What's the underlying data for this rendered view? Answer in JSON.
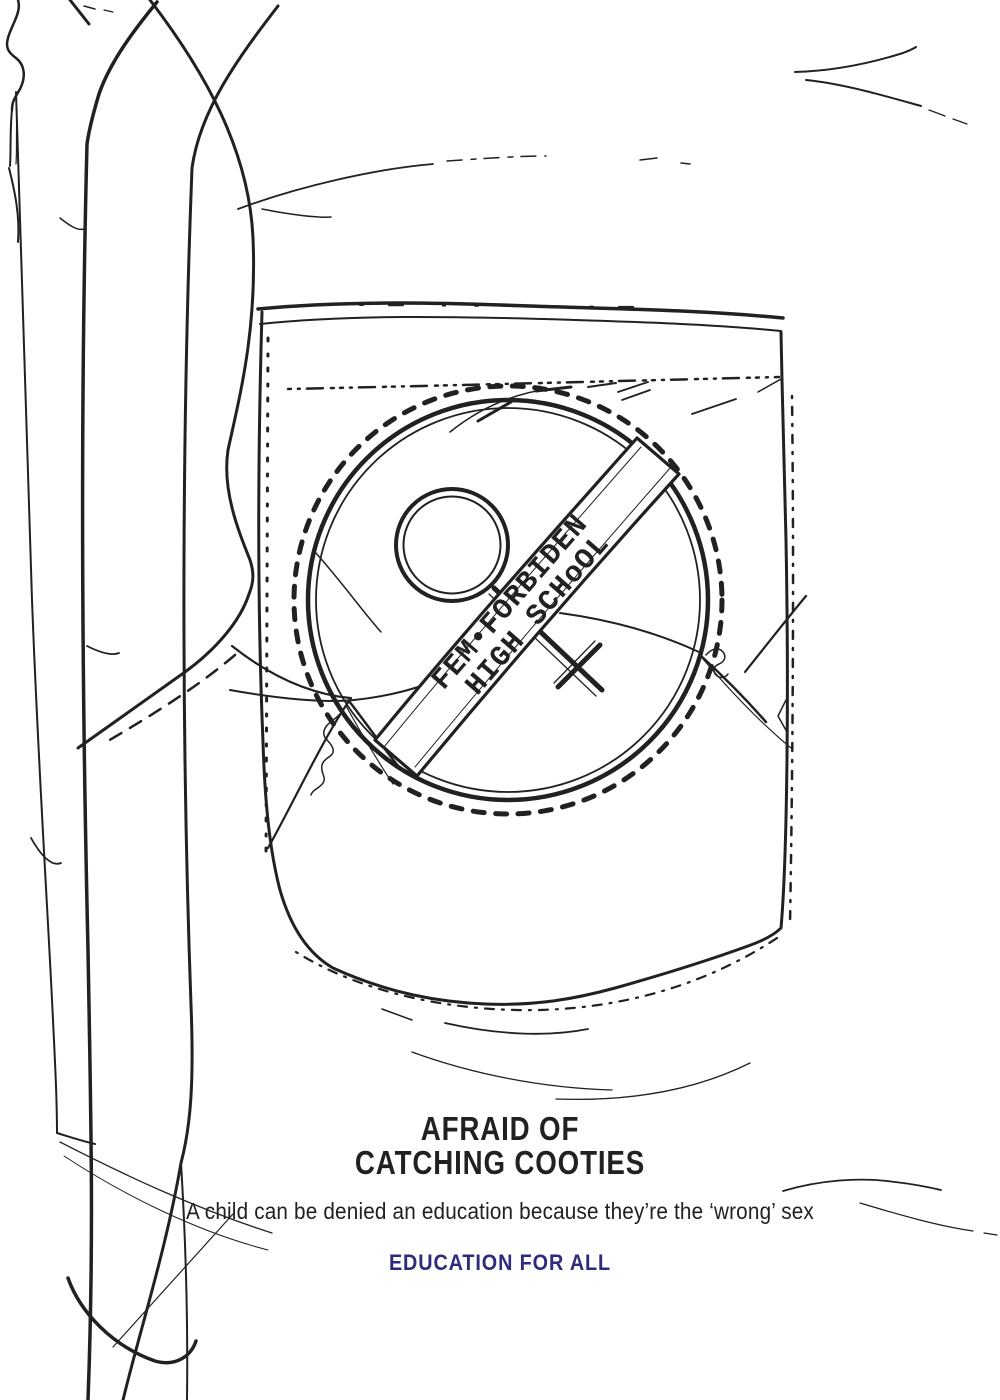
{
  "colors": {
    "ink": "#232021",
    "accent": "#2f2a7b"
  },
  "badge": {
    "symbol_icon": "female-gender-symbol",
    "banner_line1": "FEM•FORBIDEN",
    "banner_line2": "HIGH SCHoOL"
  },
  "headline": {
    "line1": "AFRAID OF",
    "line2": "CATCHING COOTIES"
  },
  "copy": {
    "text": "A child can be denied an education because they’re the ‘wrong’ sex"
  },
  "cta": {
    "text": "EDUCATION FOR ALL"
  }
}
